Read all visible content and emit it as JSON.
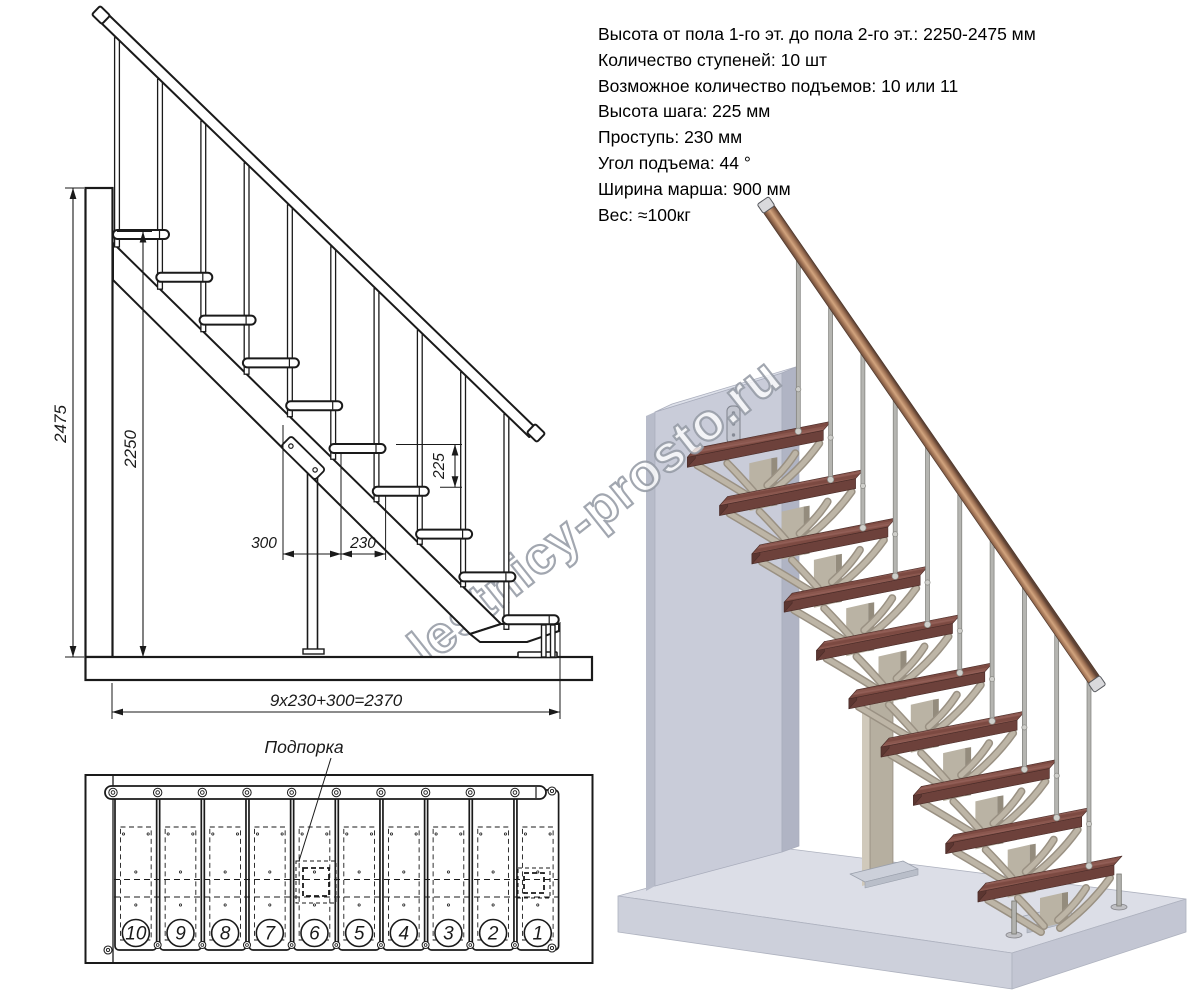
{
  "specs": {
    "lines": [
      "Высота от пола 1-го эт. до пола 2-го эт.: 2250-2475 мм",
      "Количество ступеней: 10 шт",
      "Возможное количество подъемов: 10 или 11",
      "Высота шага: 225 мм",
      "Проступь: 230 мм",
      "Угол подъема: 44 °",
      "Ширина марша: 900 мм",
      "Вес: ≈100кг"
    ]
  },
  "elevation": {
    "dim_total_height": "2475",
    "dim_clear_height": "2250",
    "dim_bottom_offset": "300",
    "dim_tread_depth": "230",
    "dim_step_rise": "225",
    "dim_total_run": "9x230+300=2370"
  },
  "plan": {
    "support_label": "Подпорка",
    "step_numbers": [
      "10",
      "9",
      "8",
      "7",
      "6",
      "5",
      "4",
      "3",
      "2",
      "1"
    ]
  },
  "watermark": {
    "text": "lestnicy-prosto.ru"
  },
  "colors": {
    "line": "#1a1a1a",
    "wall_front": "#c9ccd9",
    "wall_top": "#dde0e9",
    "wall_right": "#b0b4c4",
    "wall_left": "#b8bcca",
    "floor_top": "#dcdee7",
    "floor_front": "#cdd0db",
    "floor_right": "#c3c6d3",
    "tread_wood": "#8a574e",
    "tread_wood2": "#7c4a42",
    "tread_front": "#6d413b",
    "tread_side": "#5c3631",
    "module": "#bdb5a6",
    "module_dark": "#9a9183",
    "post": "#bab3a4",
    "post_dark": "#948c7d",
    "metal": "#b5b5b1",
    "metal_dark": "#7d7d78",
    "sphere": "#cfcfcb",
    "rail_edge": "#5e4234",
    "rail_mid": "#d2a47e",
    "rail_tone": "#9c6f52",
    "cap": "#d9d9dc",
    "plate": "#ccd0da",
    "plate_edge": "#9aa0ac"
  }
}
